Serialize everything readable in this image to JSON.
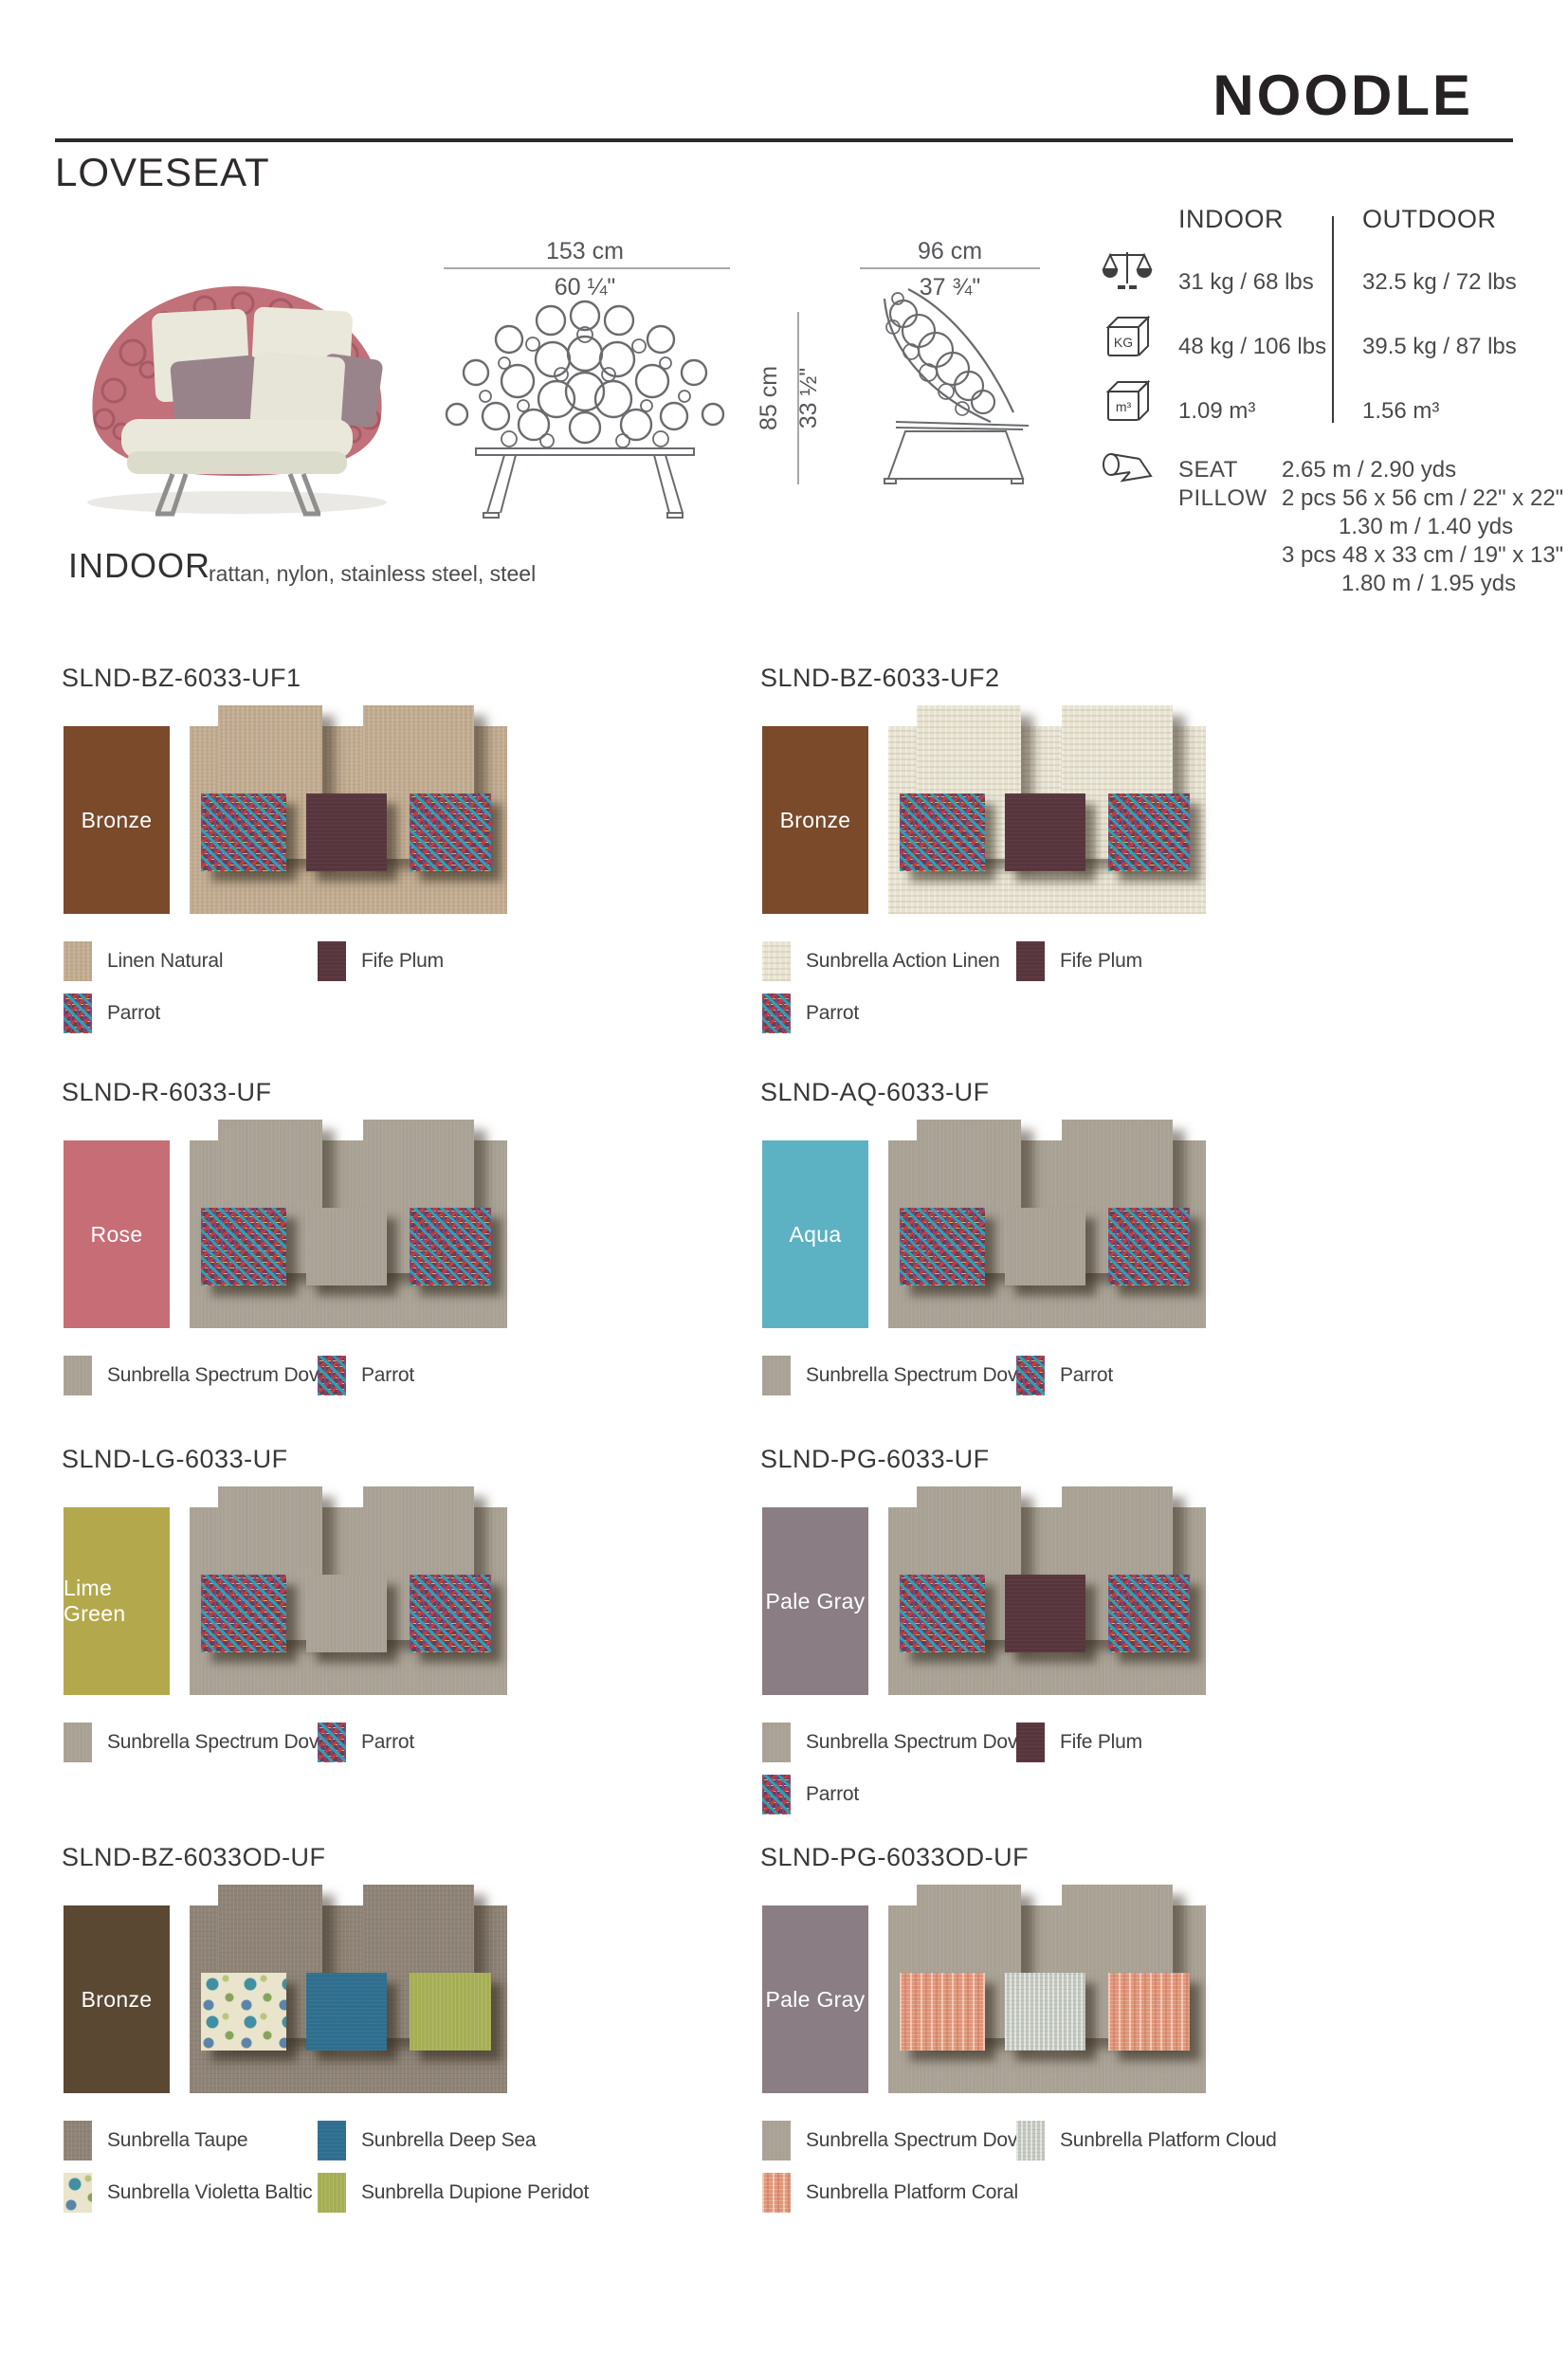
{
  "header": {
    "brand": "NOODLE",
    "product": "LOVESEAT"
  },
  "overview": {
    "width_cm": "153 cm",
    "width_in": "60 ¼\"",
    "depth_cm": "96 cm",
    "depth_in": "37 ¾\"",
    "height_cm": "85 cm",
    "height_in": "33 ½\""
  },
  "icons": {
    "weight": "scale-icon",
    "carton_weight": "kg-cube-icon",
    "volume": "m3-cube-icon",
    "yardage": "fabric-roll-icon"
  },
  "specs": {
    "col_indoor": "INDOOR",
    "col_outdoor": "OUTDOOR",
    "weight": {
      "indoor": "31 kg / 68 lbs",
      "outdoor": "32.5 kg / 72 lbs"
    },
    "carton_weight": {
      "indoor": "48 kg / 106 lbs",
      "outdoor": "39.5 kg / 87 lbs"
    },
    "volume": {
      "indoor": "1.09 m³",
      "outdoor": "1.56 m³"
    }
  },
  "yardage": {
    "seat_label": "SEAT",
    "seat_value": "2.65 m / 2.90 yds",
    "pillow_label": "PILLOW",
    "pillow_line1": "2 pcs  56 x 56 cm / 22\" x 22\"",
    "pillow_line2": "1.30 m / 1.40 yds",
    "pillow_line3": "3 pcs  48 x 33 cm / 19\" x 13\"",
    "pillow_line4": "1.80 m / 1.95 yds"
  },
  "category": {
    "label": "INDOOR",
    "materials": "rattan, nylon, stainless steel, steel"
  },
  "palette": {
    "linen-natural": "#c0aa8e",
    "action-linen": "#e7e2d1",
    "spectrum-dove": "#a8a194",
    "taupe": "#8e8376",
    "fife-plum": "#57353d",
    "deep-sea": "#2f6e8e",
    "dupione-peridot": "#a6ae55",
    "parrot-base": "#6a3f50",
    "parrot-teal": "#2ba0b8",
    "parrot-red": "#c03c44",
    "parrot-purple": "#7a4788",
    "parrot-gold": "#d9b169",
    "violetta-base": "#e9e4cb",
    "violetta-teal": "#4090a2",
    "violetta-green": "#86a35c",
    "platform-cloud": "#c4c9c0",
    "platform-coral": "#df9478"
  },
  "variants": [
    {
      "sku": "SLND-BZ-6033-UF1",
      "frame": {
        "name": "Bronze",
        "color": "#7a4a2b"
      },
      "collage": {
        "base": "linen-natural",
        "pillows": [
          "parrot",
          "fife-plum",
          "parrot"
        ]
      },
      "legend": [
        {
          "fabric": "linen-natural",
          "label": "Linen Natural"
        },
        {
          "fabric": "fife-plum",
          "label": "Fife Plum"
        },
        {
          "fabric": "parrot",
          "label": "Parrot"
        }
      ]
    },
    {
      "sku": "SLND-BZ-6033-UF2",
      "frame": {
        "name": "Bronze",
        "color": "#7a4a2b"
      },
      "collage": {
        "base": "action-linen",
        "pillows": [
          "parrot",
          "fife-plum",
          "parrot"
        ]
      },
      "legend": [
        {
          "fabric": "action-linen",
          "label": "Sunbrella Action Linen"
        },
        {
          "fabric": "fife-plum",
          "label": "Fife Plum"
        },
        {
          "fabric": "parrot",
          "label": "Parrot"
        }
      ]
    },
    {
      "sku": "SLND-R-6033-UF",
      "frame": {
        "name": "Rose",
        "color": "#c76d76"
      },
      "collage": {
        "base": "spectrum-dove",
        "pillows": [
          "parrot",
          "spectrum-dove",
          "parrot"
        ]
      },
      "legend": [
        {
          "fabric": "spectrum-dove",
          "label": "Sunbrella Spectrum Dove"
        },
        {
          "fabric": "parrot",
          "label": "Parrot"
        }
      ]
    },
    {
      "sku": "SLND-AQ-6033-UF",
      "frame": {
        "name": "Aqua",
        "color": "#5cb2c2"
      },
      "collage": {
        "base": "spectrum-dove",
        "pillows": [
          "parrot",
          "spectrum-dove",
          "parrot"
        ]
      },
      "legend": [
        {
          "fabric": "spectrum-dove",
          "label": "Sunbrella Spectrum Dove"
        },
        {
          "fabric": "parrot",
          "label": "Parrot"
        }
      ]
    },
    {
      "sku": "SLND-LG-6033-UF",
      "frame": {
        "name": "Lime Green",
        "color": "#b3a94c"
      },
      "collage": {
        "base": "spectrum-dove",
        "pillows": [
          "parrot",
          "spectrum-dove",
          "parrot"
        ]
      },
      "legend": [
        {
          "fabric": "spectrum-dove",
          "label": "Sunbrella Spectrum Dove"
        },
        {
          "fabric": "parrot",
          "label": "Parrot"
        }
      ]
    },
    {
      "sku": "SLND-PG-6033-UF",
      "frame": {
        "name": "Pale Gray",
        "color": "#8a7d84"
      },
      "collage": {
        "base": "spectrum-dove",
        "pillows": [
          "parrot",
          "fife-plum",
          "parrot"
        ]
      },
      "legend": [
        {
          "fabric": "spectrum-dove",
          "label": "Sunbrella Spectrum Dove"
        },
        {
          "fabric": "fife-plum",
          "label": "Fife Plum"
        },
        {
          "fabric": "parrot",
          "label": "Parrot"
        }
      ]
    },
    {
      "sku": "SLND-BZ-6033OD-UF",
      "frame": {
        "name": "Bronze",
        "color": "#5b4833"
      },
      "collage": {
        "base": "taupe",
        "pillows": [
          "violetta-baltic",
          "deep-sea",
          "dupione-peridot"
        ]
      },
      "legend": [
        {
          "fabric": "taupe",
          "label": "Sunbrella Taupe"
        },
        {
          "fabric": "deep-sea",
          "label": "Sunbrella Deep Sea"
        },
        {
          "fabric": "violetta-baltic",
          "label": "Sunbrella Violetta Baltic"
        },
        {
          "fabric": "dupione-peridot",
          "label": "Sunbrella Dupione Peridot"
        }
      ]
    },
    {
      "sku": "SLND-PG-6033OD-UF",
      "frame": {
        "name": "Pale Gray",
        "color": "#8a7d84"
      },
      "collage": {
        "base": "spectrum-dove",
        "pillows": [
          "platform-coral",
          "platform-cloud",
          "platform-coral"
        ]
      },
      "legend": [
        {
          "fabric": "spectrum-dove",
          "label": "Sunbrella Spectrum Dove"
        },
        {
          "fabric": "platform-cloud",
          "label": "Sunbrella Platform Cloud"
        },
        {
          "fabric": "platform-coral",
          "label": "Sunbrella Platform Coral"
        }
      ]
    }
  ]
}
